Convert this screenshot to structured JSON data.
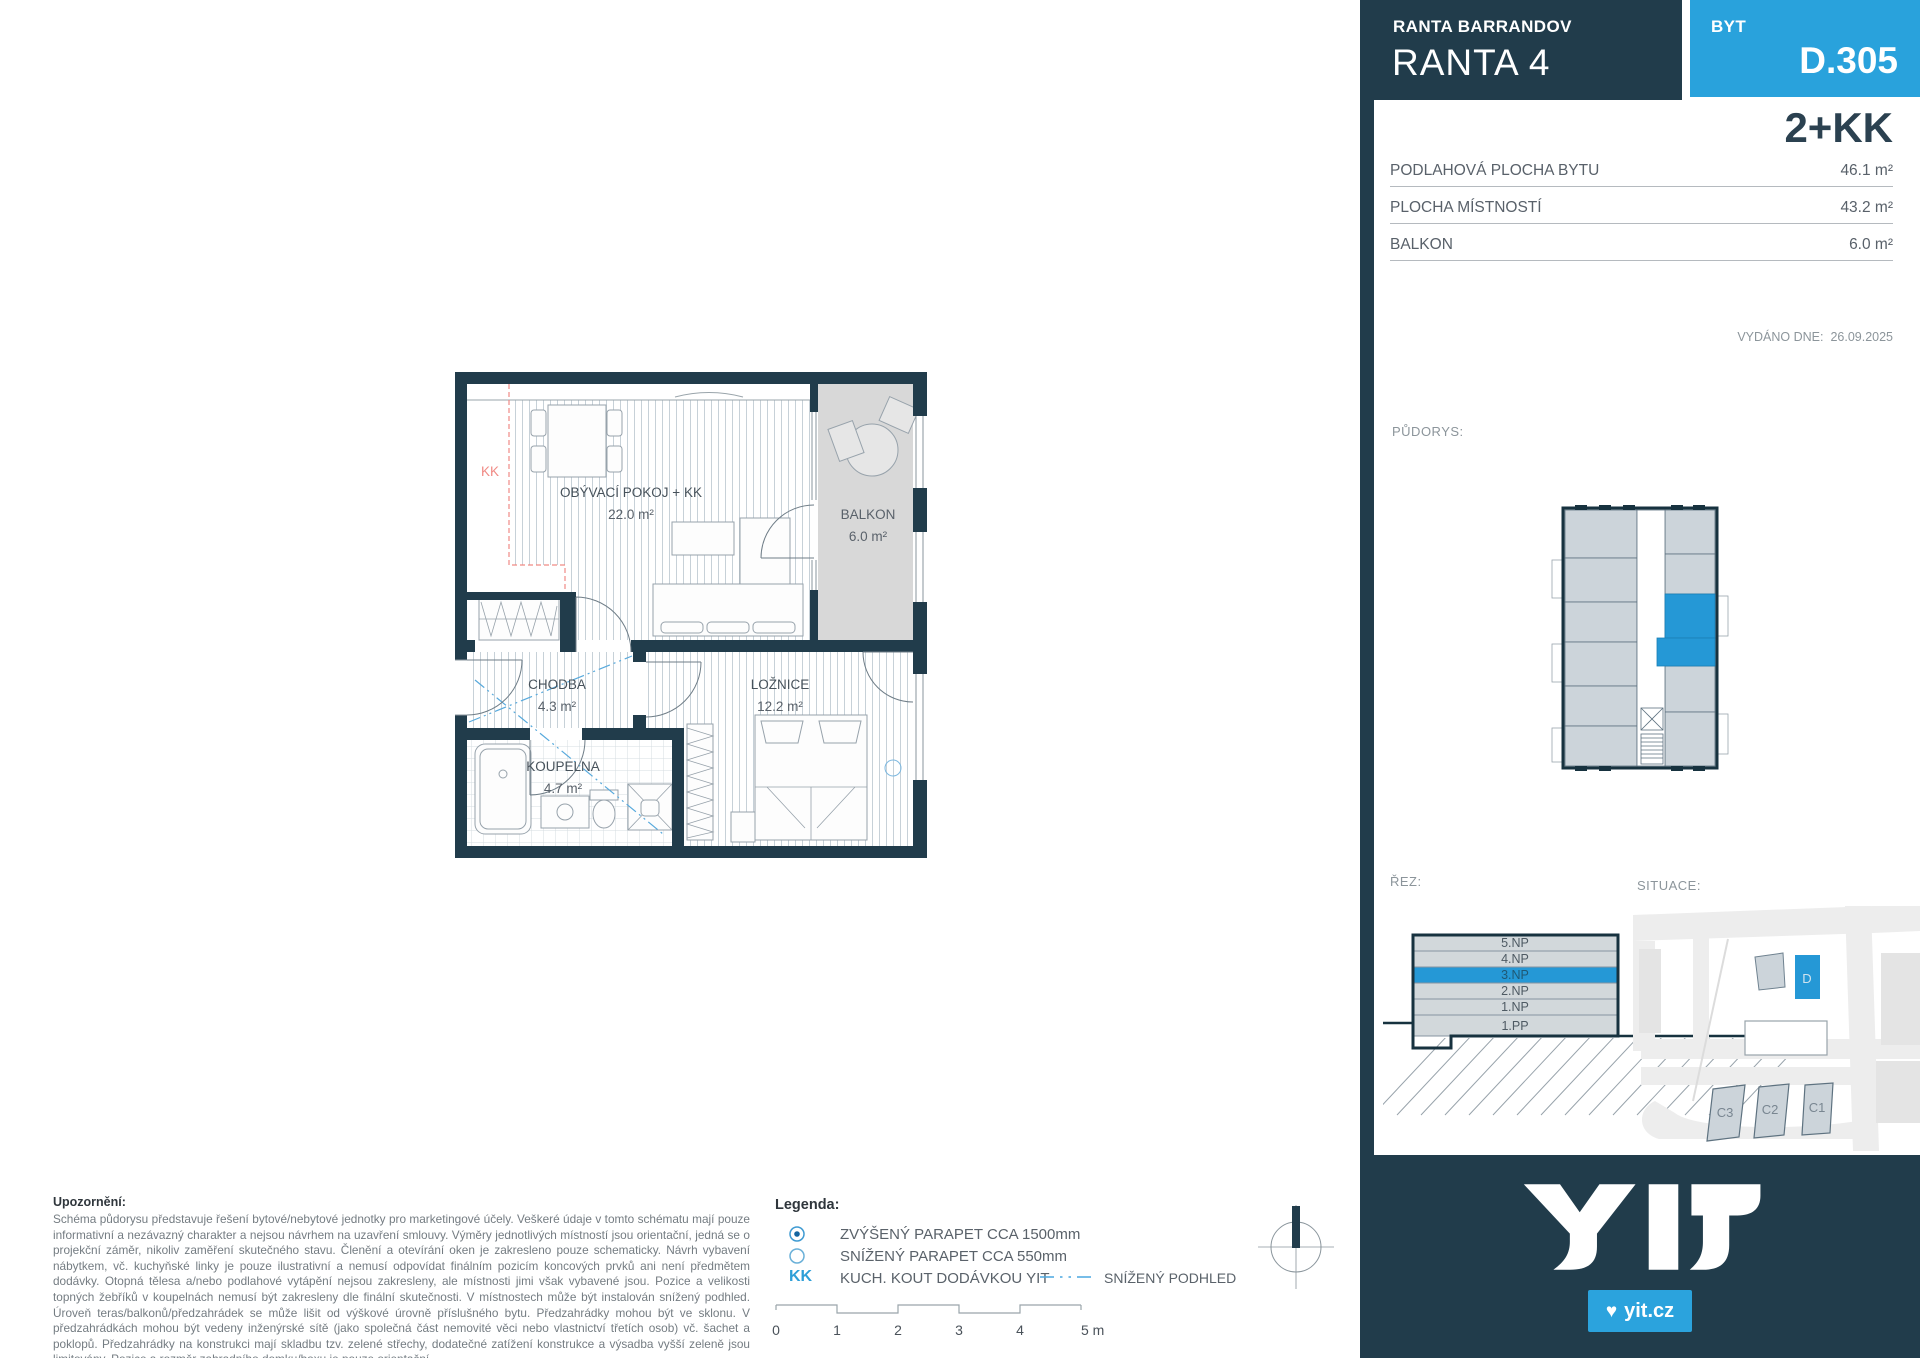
{
  "header": {
    "project": "RANTA BARRANDOV",
    "building": "RANTA 4",
    "unit_label": "BYT",
    "unit_number": "D.305",
    "disposition": "2+KK"
  },
  "areas": {
    "rows": [
      {
        "label": "PODLAHOVÁ PLOCHA BYTU",
        "value": "46.1 m²"
      },
      {
        "label": "PLOCHA MÍSTNOSTÍ",
        "value": "43.2 m²"
      },
      {
        "label": "BALKON",
        "value": "6.0 m²"
      }
    ],
    "issued_label": "VYDÁNO DNE:",
    "issued_date": "26.09.2025"
  },
  "labels": {
    "pudorys": "PŮDORYS:",
    "rez": "ŘEZ:",
    "situace": "SITUACE:"
  },
  "plan": {
    "kk": "KK",
    "living": {
      "name": "OBÝVACÍ POKOJ + KK",
      "area": "22.0 m²"
    },
    "balcony": {
      "name": "BALKON",
      "area": "6.0 m²"
    },
    "hall": {
      "name": "CHODBA",
      "area": "4.3 m²"
    },
    "bedroom": {
      "name": "LOŽNICE",
      "area": "12.2 m²"
    },
    "bathroom": {
      "name": "KOUPELNA",
      "area": "4.7 m²"
    }
  },
  "rez": {
    "floors": [
      "5.NP",
      "4.NP",
      "3.NP",
      "2.NP",
      "1.NP",
      "1.PP"
    ],
    "highlighted": "3.NP"
  },
  "situace": {
    "d": "D",
    "c3": "C3",
    "c2": "C2",
    "c1": "C1",
    "highlighted": "D"
  },
  "notice": {
    "title": "Upozornění:",
    "body": "Schéma půdorysu představuje řešení bytové/nebytové jednotky pro marketingové účely. Veškeré údaje v tomto schématu mají pouze informativní a nezávazný charakter a nejsou návrhem na uzavření smlouvy. Výměry jednotlivých místností jsou orientační, jedná se o projekční záměr, nikoliv zaměření skutečného stavu. Členění a otevírání oken je zakresleno pouze schematicky. Návrh vybavení nábytkem, vč. kuchyňské linky je pouze ilustrativní a nemusí odpovídat finálním pozicím koncových prvků ani není předmětem dodávky. Otopná tělesa a/nebo podlahové vytápění nejsou zakresleny, ale místnosti jimi však vybavené jsou. Pozice a velikosti topných žebříků v koupelnách nemusí být zakresleny dle finální skutečnosti. V místnostech může být instalován snížený podhled. Úroveň teras/balkonů/předzahrádek se může lišit od výškové úrovně příslušného bytu. Předzahrádky mohou být ve sklonu. V předzahrádkách mohou být vedeny inženýrské sítě (jako společná část nemovité věci nebo vlastnictví třetích osob) vč. šachet a poklopů. Předzahrádky na konstrukci mají skladbu tzv. zelené střechy, dodatečné zatížení konstrukce a výsadba vyšší zeleně jsou limitovány. Pozice a rozměr zahradního domku/boxu je pouze orientační."
  },
  "legend": {
    "title": "Legenda:",
    "item_raised_sill": "ZVÝŠENÝ PARAPET CCA 1500mm",
    "item_lowered_sill": "SNÍŽENÝ PARAPET CCA 550mm",
    "kk_symbol": "KK",
    "item_kitchen": "KUCH. KOUT DODÁVKOU YIT",
    "item_ceiling": "SNÍŽENÝ PODHLED"
  },
  "scalebar": {
    "t0": "0",
    "t1": "1",
    "t2": "2",
    "t3": "3",
    "t4": "4",
    "t5": "5 m"
  },
  "footer": {
    "site": "yit.cz"
  },
  "colors": {
    "dark": "#213C4B",
    "accent": "#29A2DC",
    "plan_blue": "#2598D6",
    "balcony_fill": "#D8D8D8",
    "kk_pink": "#F08A85"
  }
}
